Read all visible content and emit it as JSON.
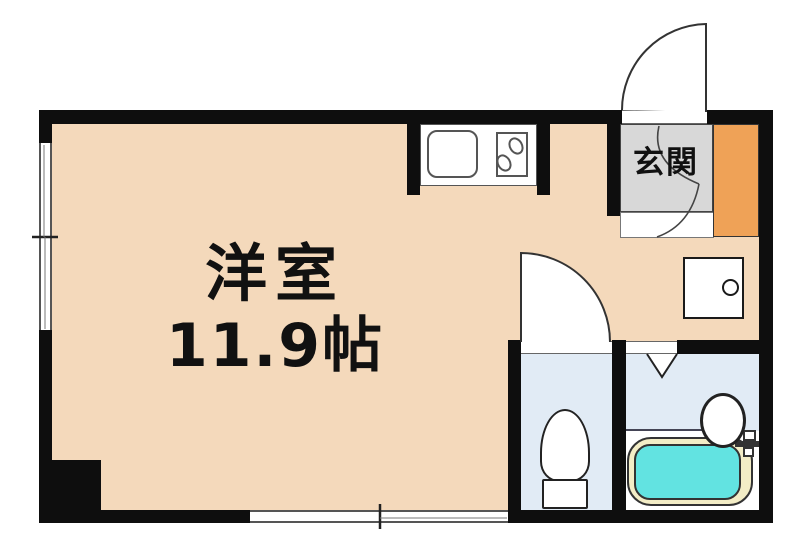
{
  "plan": {
    "type": "apartment-floor-plan",
    "rooms": {
      "main_room": {
        "name": "洋室",
        "size": "11.9帖"
      },
      "entrance": {
        "name": "玄関"
      }
    },
    "fixtures": [
      "kitchen-sink",
      "gas-stove-2-burner",
      "entry-door",
      "toilet-door",
      "bathroom-folding-door",
      "washing-machine-pan",
      "toilet",
      "bathtub",
      "washbasin",
      "shoe-cabinet",
      "genkan-step",
      "window-left",
      "window-bottom"
    ]
  },
  "colors": {
    "wall": "#0e0e0e",
    "floor_main": "#f4d9bb",
    "floor_entrance": "#d8d8d8",
    "cabinet": "#efa257",
    "floor_wet": "#e1ebf5",
    "bathtub_water": "#62e3e1",
    "bathtub_rim": "#f3edc6",
    "outline": "#222222",
    "label": "#111111"
  }
}
